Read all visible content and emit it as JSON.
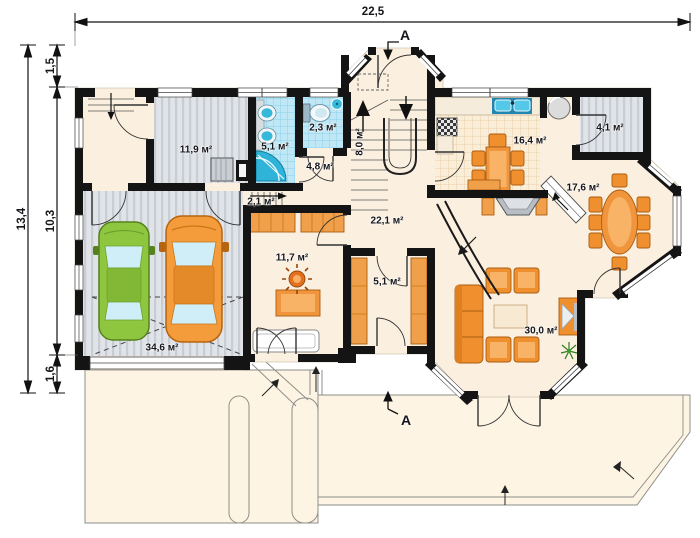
{
  "plan": {
    "dimensions": {
      "width_total": "22,5",
      "height_total": "13,4",
      "height_top": "1,5",
      "height_middle": "10,3",
      "height_bottom": "1,6"
    },
    "section_marks": {
      "top": "A",
      "bottom": "A"
    },
    "rooms": [
      {
        "id": "utility-room",
        "area": "11,9 м²"
      },
      {
        "id": "bathroom",
        "area": "5,1 м²"
      },
      {
        "id": "wc",
        "area": "2,3 м²"
      },
      {
        "id": "corridor",
        "area": "4,8 м²"
      },
      {
        "id": "staircase",
        "area": "8,0 м²"
      },
      {
        "id": "kitchen",
        "area": "16,4 м²"
      },
      {
        "id": "pantry",
        "area": "4,1 м²"
      },
      {
        "id": "dining-room",
        "area": "17,6 м²"
      },
      {
        "id": "hall",
        "area": "22,1 м²"
      },
      {
        "id": "study",
        "area": "11,7 м²"
      },
      {
        "id": "wardrobe",
        "area": "5,1 м²"
      },
      {
        "id": "living-room",
        "area": "30,0 м²"
      },
      {
        "id": "garage",
        "area": "34,6 м²"
      },
      {
        "id": "garage-steps",
        "area": "2,1 м²"
      }
    ],
    "colors": {
      "wall": "#141414",
      "floor_cream": "#fbf0df",
      "floor_gray": "#e0e4e8",
      "tile_blue": "#bfe7f5",
      "kitchen_grid": "#fbeed8",
      "furniture_orange": "#ef8f2e",
      "car_green": "#8ec63f",
      "car_orange": "#f49c3c"
    }
  }
}
